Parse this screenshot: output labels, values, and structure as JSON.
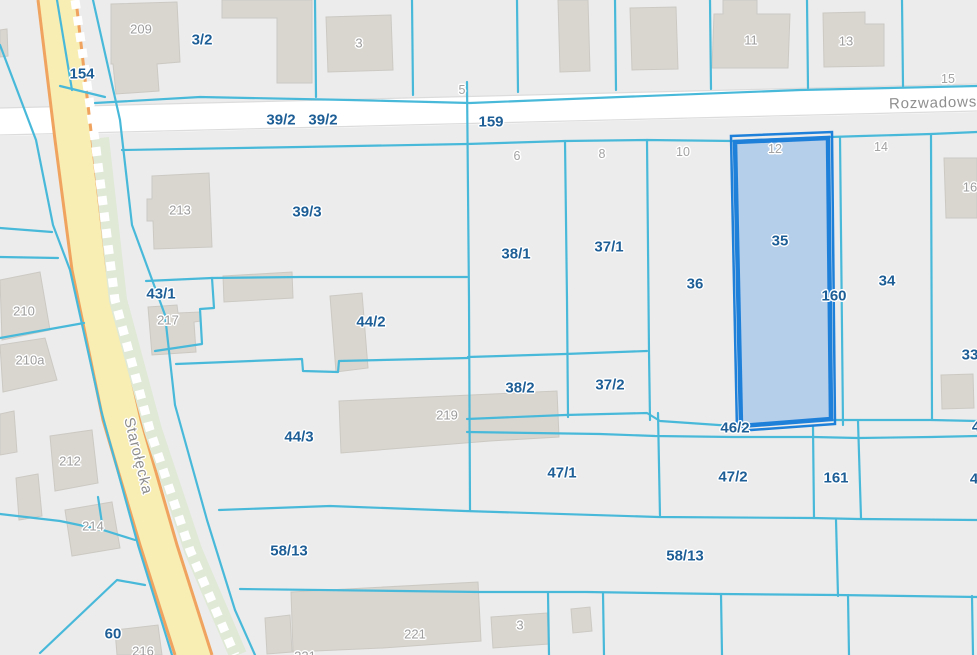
{
  "app": {
    "type": "cadastral-map-viewer"
  },
  "selected_parcel": {
    "number": "35",
    "fill": "#abc9e9",
    "border": "#1f80da"
  },
  "colors": {
    "background": "#ececec",
    "parcel_line": "#49b9da",
    "parcel_label": "#1d5e96",
    "building_fill": "#d9d6d0",
    "building_label": "#9c9c9c",
    "highlight_fill": "#abc9e9",
    "highlight_border": "#1f80da",
    "road_fill": "#f8edb2",
    "road_edge": "#efa35f",
    "side_road_fill": "#ffffff"
  },
  "streets": [
    {
      "name": "Starołęcka"
    },
    {
      "name": "Rozwadows"
    }
  ],
  "map": {
    "labels": [
      {
        "type": "parcel",
        "text": "154",
        "x": 82,
        "y": 74
      },
      {
        "type": "parcel",
        "text": "3/2",
        "x": 202,
        "y": 40
      },
      {
        "type": "parcel",
        "text": "39/2",
        "x": 281,
        "y": 120
      },
      {
        "type": "parcel",
        "text": "39/2",
        "x": 323,
        "y": 120
      },
      {
        "type": "parcel",
        "text": "159",
        "x": 491,
        "y": 122
      },
      {
        "type": "parcel",
        "text": "39/3",
        "x": 307,
        "y": 212
      },
      {
        "type": "parcel",
        "text": "43/1",
        "x": 161,
        "y": 294
      },
      {
        "type": "parcel",
        "text": "44/2",
        "x": 371,
        "y": 322
      },
      {
        "type": "parcel",
        "text": "38/1",
        "x": 516,
        "y": 254
      },
      {
        "type": "parcel",
        "text": "37/1",
        "x": 609,
        "y": 247
      },
      {
        "type": "parcel",
        "text": "36",
        "x": 695,
        "y": 284
      },
      {
        "type": "parcel",
        "text": "35",
        "x": 780,
        "y": 241
      },
      {
        "type": "parcel",
        "text": "160",
        "x": 834,
        "y": 296
      },
      {
        "type": "parcel",
        "text": "34",
        "x": 887,
        "y": 281
      },
      {
        "type": "parcel",
        "text": "38/2",
        "x": 520,
        "y": 388
      },
      {
        "type": "parcel",
        "text": "37/2",
        "x": 610,
        "y": 385
      },
      {
        "type": "parcel",
        "text": "44/3",
        "x": 299,
        "y": 437
      },
      {
        "type": "parcel",
        "text": "46/2",
        "x": 735,
        "y": 428
      },
      {
        "type": "parcel",
        "text": "47/1",
        "x": 562,
        "y": 473
      },
      {
        "type": "parcel",
        "text": "47/2",
        "x": 733,
        "y": 477
      },
      {
        "type": "parcel",
        "text": "161",
        "x": 836,
        "y": 478
      },
      {
        "type": "parcel",
        "text": "58/13",
        "x": 289,
        "y": 551
      },
      {
        "type": "parcel",
        "text": "58/13",
        "x": 685,
        "y": 556
      },
      {
        "type": "parcel",
        "text": "60",
        "x": 113,
        "y": 634
      },
      {
        "type": "parcel",
        "text": "33",
        "x": 970,
        "y": 355
      },
      {
        "type": "parcel",
        "text": "4",
        "x": 976,
        "y": 427
      },
      {
        "type": "parcel",
        "text": "4",
        "x": 974,
        "y": 479
      },
      {
        "type": "building",
        "text": "209",
        "x": 141,
        "y": 29
      },
      {
        "type": "building",
        "text": "3",
        "x": 359,
        "y": 43
      },
      {
        "type": "building",
        "text": "11",
        "x": 751,
        "y": 40
      },
      {
        "type": "building",
        "text": "13",
        "x": 846,
        "y": 41
      },
      {
        "type": "building",
        "text": "213",
        "x": 180,
        "y": 210
      },
      {
        "type": "building",
        "text": "217",
        "x": 168,
        "y": 320
      },
      {
        "type": "building",
        "text": "210",
        "x": 24,
        "y": 311
      },
      {
        "type": "building",
        "text": "210a",
        "x": 30,
        "y": 360
      },
      {
        "type": "building",
        "text": "219",
        "x": 447,
        "y": 415
      },
      {
        "type": "building",
        "text": "212",
        "x": 70,
        "y": 461
      },
      {
        "type": "building",
        "text": "214",
        "x": 93,
        "y": 526
      },
      {
        "type": "building",
        "text": "216",
        "x": 143,
        "y": 651
      },
      {
        "type": "building",
        "text": "221",
        "x": 415,
        "y": 634
      },
      {
        "type": "building",
        "text": "221",
        "x": 305,
        "y": 656
      },
      {
        "type": "building",
        "text": "3",
        "x": 520,
        "y": 625
      },
      {
        "type": "building",
        "text": "16",
        "x": 970,
        "y": 187
      },
      {
        "type": "address",
        "text": "5",
        "x": 462,
        "y": 90
      },
      {
        "type": "address",
        "text": "15",
        "x": 948,
        "y": 79
      },
      {
        "type": "address",
        "text": "6",
        "x": 517,
        "y": 156
      },
      {
        "type": "address",
        "text": "8",
        "x": 602,
        "y": 154
      },
      {
        "type": "address",
        "text": "10",
        "x": 683,
        "y": 152
      },
      {
        "type": "address",
        "text": "12",
        "x": 775,
        "y": 149
      },
      {
        "type": "address",
        "text": "14",
        "x": 881,
        "y": 147
      },
      {
        "type": "street",
        "text": "Starołęcka",
        "x": 138,
        "y": 456,
        "rot": 76
      },
      {
        "type": "street",
        "text": "Rozwadows",
        "x": 933,
        "y": 103,
        "rot": -1.4
      }
    ]
  }
}
